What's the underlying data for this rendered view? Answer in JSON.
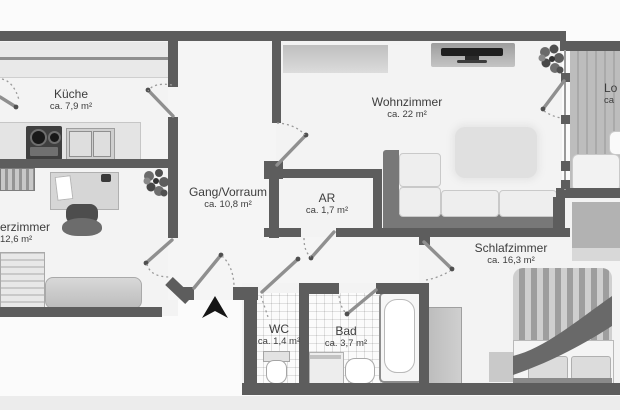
{
  "plan": {
    "type": "floorplan",
    "rooms": [
      {
        "name": "Küche",
        "area": "ca. 7,9 m²"
      },
      {
        "name": "erzimmer",
        "area": "12,6 m²"
      },
      {
        "name": "Gang/Vorraum",
        "area": "ca. 10,8 m²"
      },
      {
        "name": "Wohnzimmer",
        "area": "ca. 22 m²"
      },
      {
        "name": "AR",
        "area": "ca. 1,7 m²"
      },
      {
        "name": "Schlafzimmer",
        "area": "ca. 16,3 m²"
      },
      {
        "name": "WC",
        "area": "ca. 1,4 m²"
      },
      {
        "name": "Bad",
        "area": "ca. 3,7 m²"
      },
      {
        "name": "Lo",
        "area": "ca"
      }
    ],
    "colors": {
      "wall": "#5d5d5d",
      "floor": "#f3f3f3",
      "background": "#fbfbfb",
      "accent": "#161616"
    }
  }
}
